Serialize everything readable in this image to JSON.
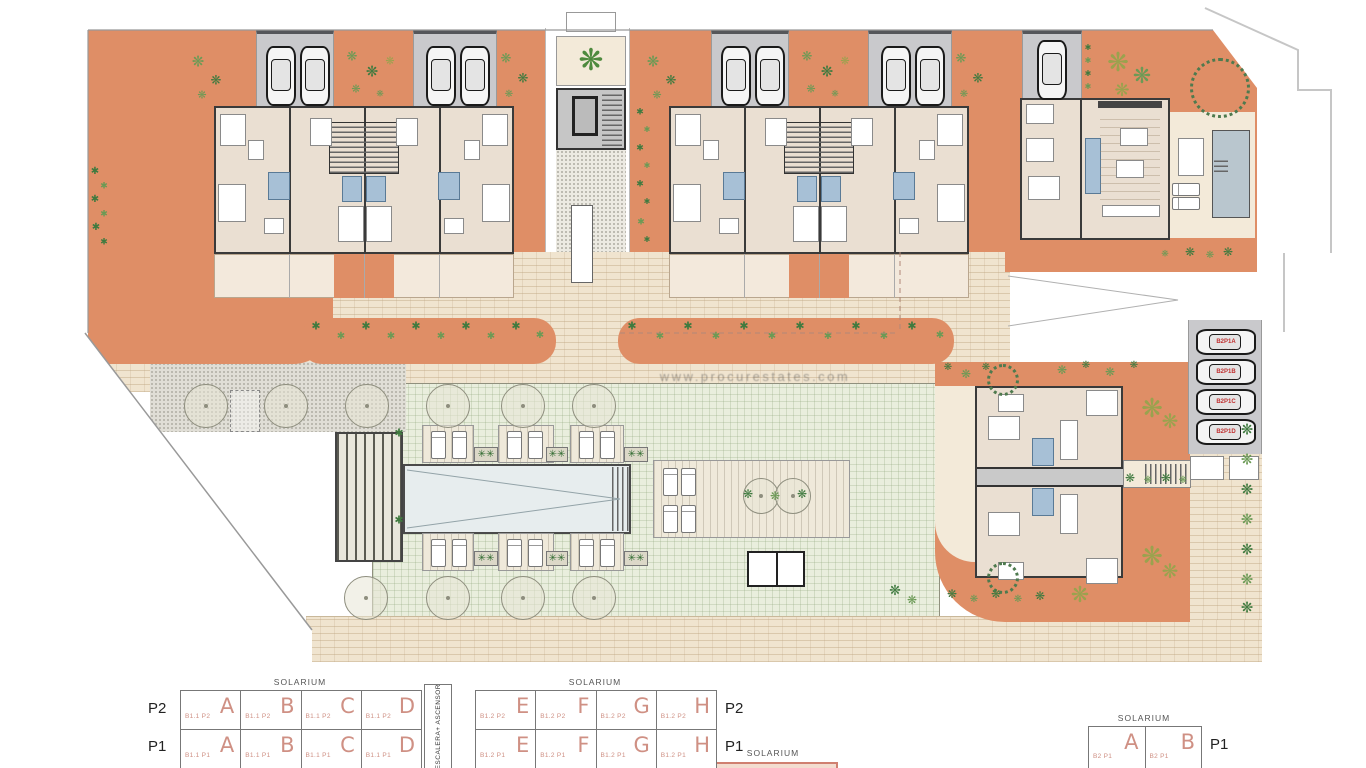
{
  "title": "Residential complex site plan",
  "watermark": "www.procurestates.com",
  "colors": {
    "terrace_orange": "#df8e66",
    "building_floor": "#eadfd2",
    "wall_dark": "#3a3a3a",
    "paving_beige": "#f0e4cf",
    "lawn_green": "#e9eedd",
    "pool_water": "#e7edee",
    "villa_pool": "#b9c6ce",
    "bathroom_blue": "#a7c0d6",
    "parking_gray": "#c9c9cc",
    "plant_green": "#3f7a3f",
    "car_label_red": "#c03030",
    "legend_red": "#cf9084"
  },
  "parking": {
    "labels": [
      "B2P1A",
      "B2P1B",
      "B2P1C",
      "B2P1D"
    ]
  },
  "legend": {
    "stair_box_label": "ESCALERA+ ASCENSOR",
    "bottom_center_solarium": "SOLARIUM",
    "tables": [
      {
        "name": "B1.1",
        "solarium": "SOLARIUM",
        "level_side": "left",
        "rows": [
          {
            "level": "P2",
            "cells": [
              {
                "code": "B1.1 P2",
                "letter": "A"
              },
              {
                "code": "B1.1 P2",
                "letter": "B"
              },
              {
                "code": "B1.1 P2",
                "letter": "C"
              },
              {
                "code": "B1.1 P2",
                "letter": "D"
              }
            ]
          },
          {
            "level": "P1",
            "cells": [
              {
                "code": "B1.1 P1",
                "letter": "A"
              },
              {
                "code": "B1.1 P1",
                "letter": "B"
              },
              {
                "code": "B1.1 P1",
                "letter": "C"
              },
              {
                "code": "B1.1 P1",
                "letter": "D"
              }
            ]
          }
        ]
      },
      {
        "name": "B1.2",
        "solarium": "SOLARIUM",
        "level_side": "right",
        "rows": [
          {
            "level": "P2",
            "cells": [
              {
                "code": "B1.2 P2",
                "letter": "E"
              },
              {
                "code": "B1.2 P2",
                "letter": "F"
              },
              {
                "code": "B1.2 P2",
                "letter": "G"
              },
              {
                "code": "B1.2 P2",
                "letter": "H"
              }
            ]
          },
          {
            "level": "P1",
            "cells": [
              {
                "code": "B1.2 P1",
                "letter": "E"
              },
              {
                "code": "B1.2 P1",
                "letter": "F"
              },
              {
                "code": "B1.2 P1",
                "letter": "G"
              },
              {
                "code": "B1.2 P1",
                "letter": "H"
              }
            ]
          }
        ]
      },
      {
        "name": "B2",
        "solarium": "SOLARIUM",
        "level_side": "right",
        "rows": [
          {
            "level": "P1",
            "cells": [
              {
                "code": "B2 P1",
                "letter": "A"
              },
              {
                "code": "B2 P1",
                "letter": "B"
              }
            ]
          }
        ]
      }
    ]
  }
}
